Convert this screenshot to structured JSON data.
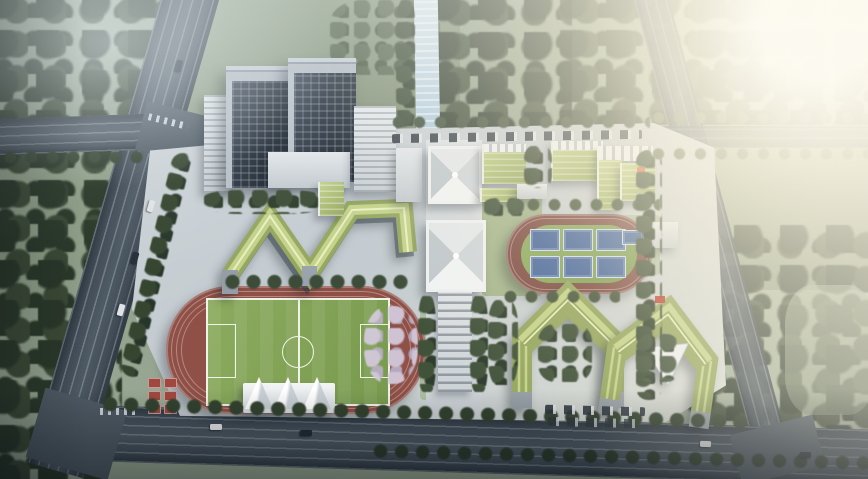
{
  "scene": {
    "type": "aerial-architectural-rendering",
    "setting": "bird's-eye view of a school campus at hazy daybreak, sun glare upper right",
    "labels": {
      "towers": "twin high-rise towers with dark glass grid facades",
      "teaching_zigzag": "zigzag teaching building with green roofs",
      "axis_halls": "central axis halls with X-ridged white hip roofs",
      "colonnade": "central axis colonnade walkway",
      "green_slabs": "laboratory slab blocks with green roofs",
      "kindergarten": "L-shaped block with green roof and rooftop play deck",
      "big_track": "400m running track with soccer pitch and tent canopies",
      "small_track": "small running track enclosing six blue basketball courts",
      "dorm_rings": "two chevron-shaped dormitory rings with green roofs",
      "stands": "red spectator stands",
      "blossom_grove": "pale blossom grove inside east track curve",
      "stream": "light blue stream north of campus",
      "roads": "arterial roads with lane markings, crossings and traffic",
      "forest": "dense dark tree masses around the site",
      "sun_glow": "bright warm sun glare in upper-right corner"
    }
  },
  "palette": {
    "forest": "#3c4a36",
    "forestDark": "#2a3829",
    "meadow": "#74836a",
    "meadowLight": "#9aa88e",
    "roadDark": "#414c57",
    "roadMid": "#4e5a64",
    "roadEdge": "#333d46",
    "towerLight": "#b7c0c7",
    "roofGreen": "#c3d289",
    "roofGreenDark": "#94a65f",
    "lawn": "#9db080",
    "trackRed": "#8e5047",
    "fieldGreen": "#789a4e",
    "fieldGreenLight": "#8cab5e",
    "lineWhite": "#eef4e8",
    "courtBlue": "#44659c",
    "standsRed": "#a04840",
    "blossom": "#cfc5d6",
    "treeDark": "#2e3d2d",
    "treeMid": "#41523b",
    "treeSun": "#5d6b4c",
    "sunCore": "#fffdf4"
  }
}
